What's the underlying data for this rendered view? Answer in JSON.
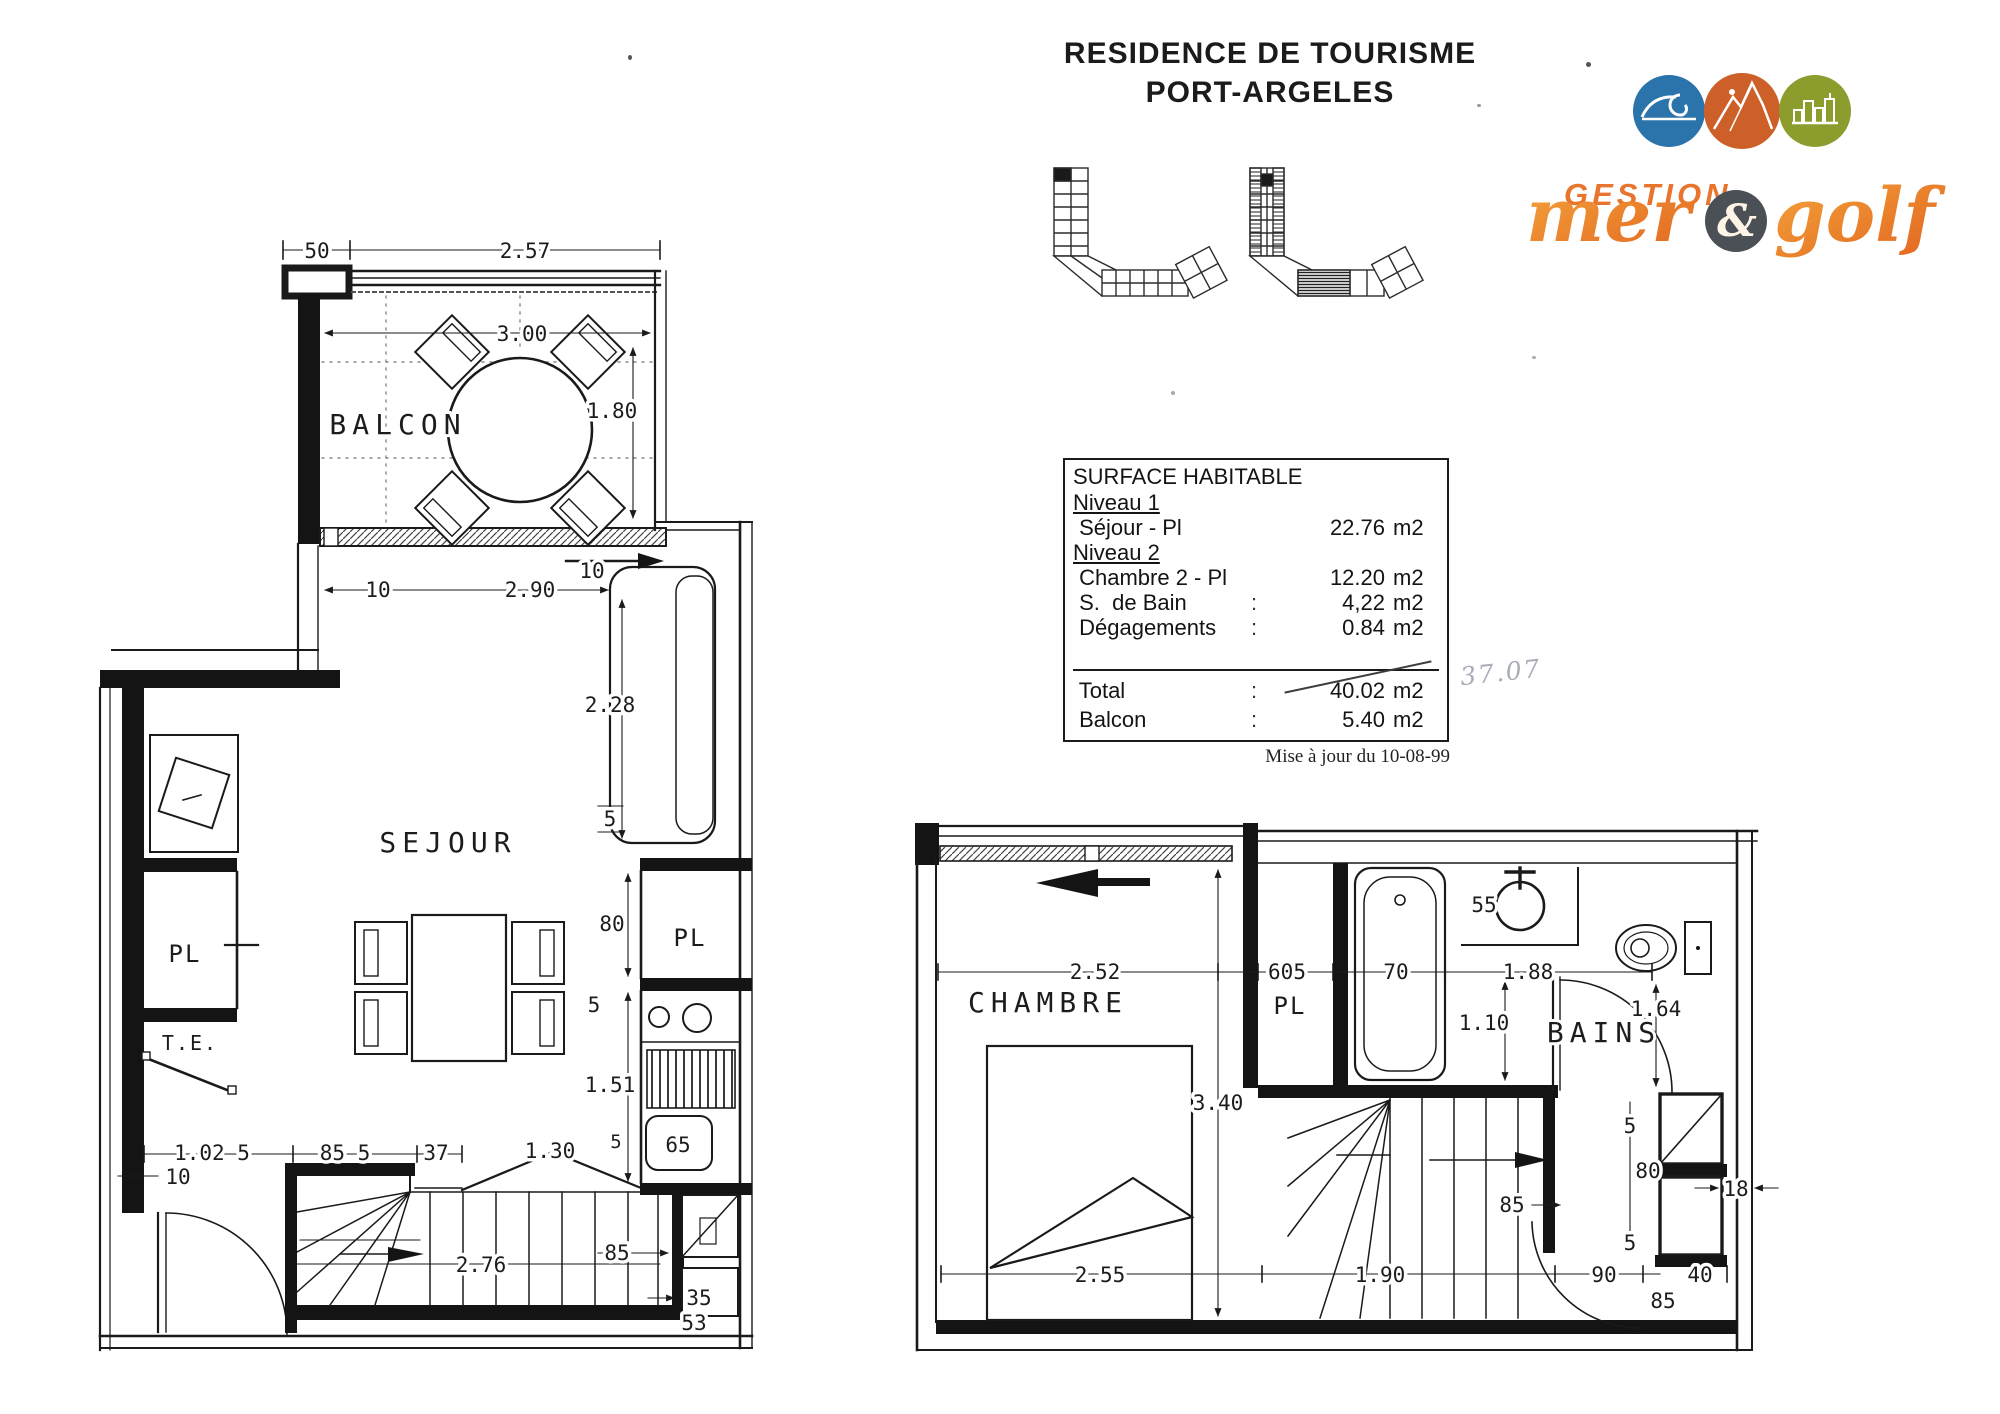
{
  "header": {
    "title_line1": "RESIDENCE DE TOURISME",
    "title_line2": "PORT-ARGELES"
  },
  "logo": {
    "gestion": "GESTION",
    "mer": "mer",
    "ampersand": "&",
    "golf": "golf",
    "colors": {
      "sea_circle": "#2a73ab",
      "mountain_circle": "#cd5f28",
      "city_circle": "#8d9d2d",
      "brand_orange": "#e8742e",
      "amp_circle": "#4b5056"
    }
  },
  "surface_table": {
    "title": "SURFACE HABITABLE",
    "sections": [
      {
        "heading": "Niveau 1",
        "rows": [
          {
            "label": " Séjour - Pl",
            "colon": "",
            "value": "22.76",
            "unit": "m2"
          }
        ]
      },
      {
        "heading": "Niveau 2",
        "rows": [
          {
            "label": " Chambre 2 - Pl",
            "colon": "",
            "value": "12.20",
            "unit": "m2"
          },
          {
            "label": " S.  de Bain",
            "colon": ":",
            "value": "4,22",
            "unit": "m2"
          },
          {
            "label": " Dégagements",
            "colon": ":",
            "value": "0.84",
            "unit": "m2"
          }
        ]
      }
    ],
    "total_row": {
      "label": " Total",
      "colon": ":",
      "value": "40.02",
      "unit": "m2"
    },
    "handwritten_correction": "37.07",
    "balcon_row": {
      "label": " Balcon",
      "colon": ":",
      "value": "5.40",
      "unit": "m2"
    },
    "footnote": "Mise à jour du 10-08-99"
  },
  "plan_niveau1": {
    "labels": {
      "balcon": "BALCON",
      "sejour": "SEJOUR",
      "pl_entry": "PL",
      "te": "T.E.",
      "pl_kitchen": "PL"
    },
    "dims": [
      "50",
      "2.57",
      "3.00",
      "1.80",
      "10",
      "2.90",
      "10",
      "2.28",
      "5",
      "80",
      "5",
      "1.51",
      "65",
      "1.02 5",
      "10",
      "85 5",
      "37",
      "1.30",
      "5",
      "2.76",
      "85",
      "35",
      "53"
    ]
  },
  "plan_niveau2": {
    "labels": {
      "chambre": "CHAMBRE",
      "pl": "PL",
      "bains": "BAINS"
    },
    "dims": [
      "2.52",
      "3.40",
      "605",
      "70",
      "1.88",
      "55",
      "1.10",
      "1.64",
      "5",
      "80",
      "18",
      "5",
      "90",
      "40",
      "85",
      "2.55",
      "1.90",
      "85"
    ]
  }
}
